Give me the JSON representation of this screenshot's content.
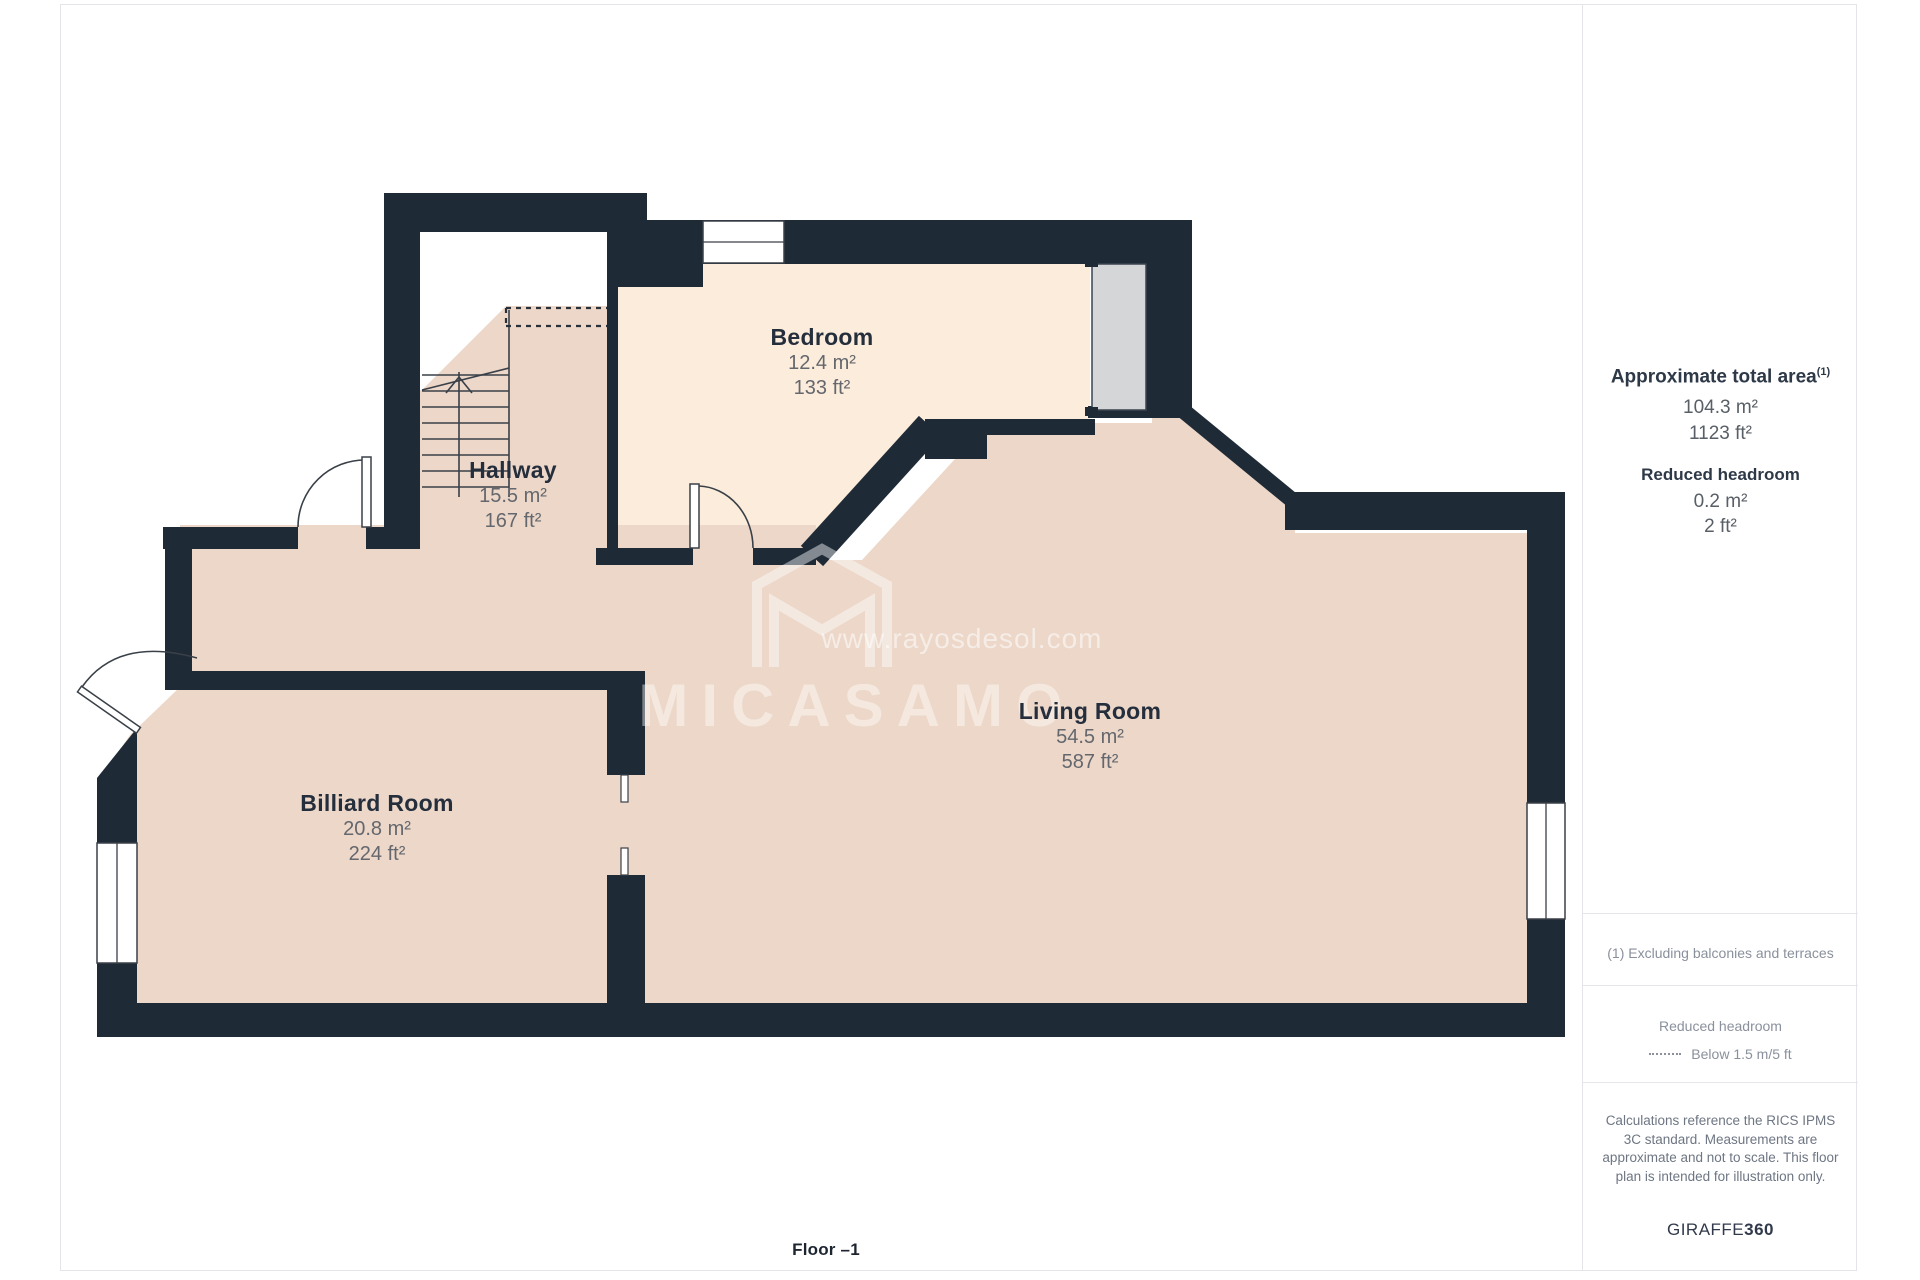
{
  "page": {
    "floor_label": "Floor –1"
  },
  "watermark": {
    "url": "www.rayosdesol.com",
    "brand": "MICASAMO",
    "logo": "house-m-logo"
  },
  "rooms": [
    {
      "name": "Bedroom",
      "area_m2": "12.4 m²",
      "area_ft2": "133 ft²"
    },
    {
      "name": "Hallway",
      "area_m2": "15.5 m²",
      "area_ft2": "167 ft²"
    },
    {
      "name": "Living Room",
      "area_m2": "54.5 m²",
      "area_ft2": "587 ft²"
    },
    {
      "name": "Billiard Room",
      "area_m2": "20.8 m²",
      "area_ft2": "224 ft²"
    }
  ],
  "sidebar": {
    "total_area": {
      "label": "Approximate total area",
      "footnote_marker": "(1)",
      "m2": "104.3 m²",
      "ft2": "1123 ft²"
    },
    "reduced_headroom": {
      "label": "Reduced headroom",
      "m2": "0.2 m²",
      "ft2": "2 ft²"
    },
    "footnote": "(1) Excluding balconies and terraces",
    "legend": {
      "title": "Reduced headroom",
      "dash_label": "Below 1.5 m/5 ft"
    },
    "disclaimer": "Calculations reference the RICS IPMS 3C standard. Measurements are approximate and not to scale. This floor plan is intended for illustration only.",
    "brand": {
      "name": "GIRAFFE",
      "suffix": "360"
    }
  },
  "colors": {
    "wall": "#1f2a37",
    "room_fill": "#ecd7c9",
    "bedroom_fill": "#fcecdb",
    "sliding_door_fill": "#d5d6d8",
    "border": "#e5e5e9",
    "label_title": "#252e3c",
    "label_value": "#64676d"
  }
}
